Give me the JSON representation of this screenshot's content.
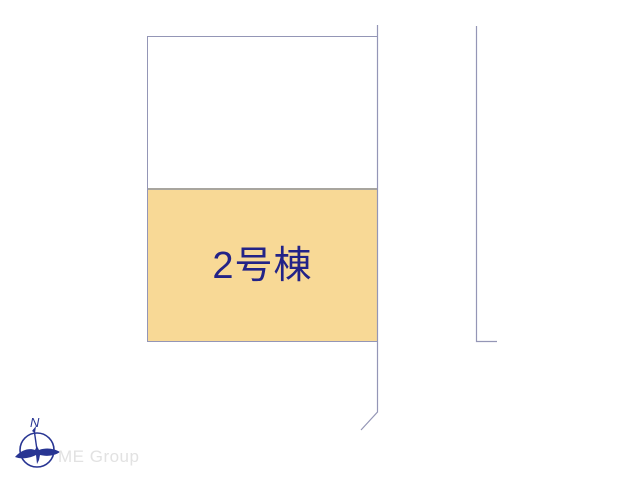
{
  "plan": {
    "building_label": "2号棟",
    "building_fill": "#f8d996",
    "label_color": "#232387",
    "boundary_color": "#9496b6",
    "divider_color": "#a8a59e"
  },
  "compass": {
    "north_label": "N",
    "color": "#283593"
  },
  "watermark": {
    "text": "ME Group",
    "color": "#e2e2e2"
  }
}
